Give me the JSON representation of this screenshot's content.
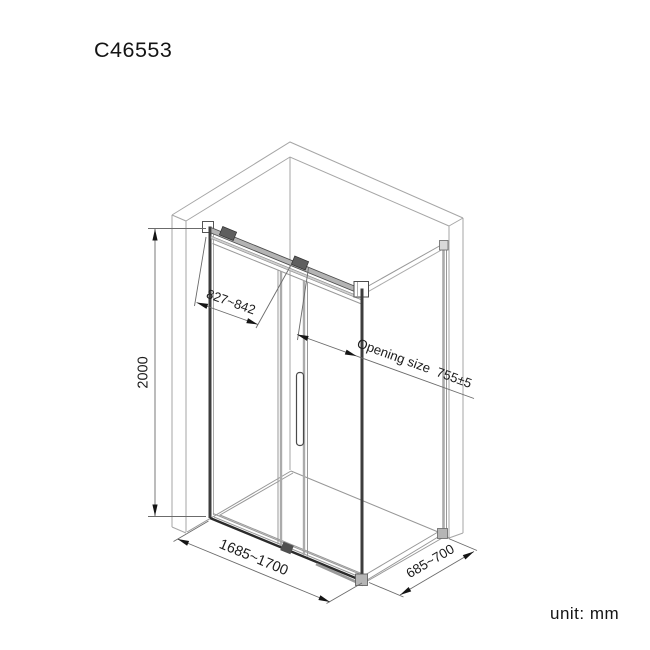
{
  "title": "C46553",
  "unit_label": "unit: mm",
  "diagram": {
    "kind": "isometric-technical-drawing",
    "subject": "corner shower enclosure with sliding glass door, side panel and two walls",
    "dimensions": {
      "height": "2000",
      "door_panel_width": "827~842",
      "opening_size": "Opening size  755±5",
      "front_width": "1685~1700",
      "side_depth": "685~700"
    },
    "colors": {
      "background": "#ffffff",
      "wall_line": "#a6a6a6",
      "floor_line": "#979797",
      "glass_edge": "#ababab",
      "frame_dark": "#3d3d3d",
      "rail_fill": "#b4b4b4",
      "dimension_line": "#6b6b6b",
      "text": "#1c1c1c"
    }
  }
}
